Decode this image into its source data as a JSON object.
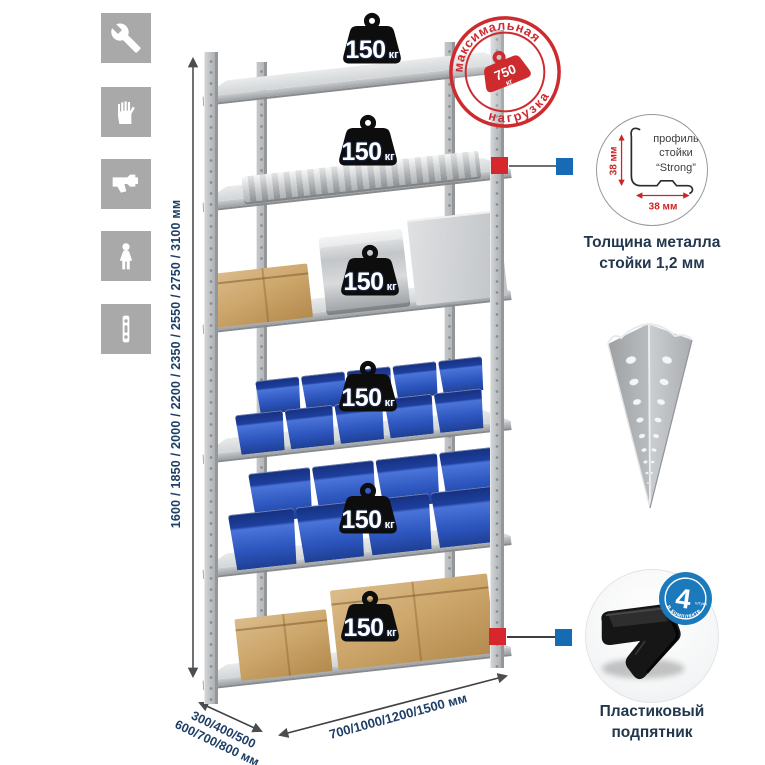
{
  "sidebar": {
    "items": [
      {
        "icon": "wrench-icon"
      },
      {
        "icon": "gloves-icon"
      },
      {
        "icon": "drill-icon"
      },
      {
        "icon": "person-icon"
      },
      {
        "icon": "perforated-strip-icon"
      }
    ]
  },
  "dimensions": {
    "height": "1600 / 1850 / 2000 / 2200 / 2350 / 2550 / 2750 / 3100 мм",
    "depth_line1": "300/400/500",
    "depth_line2": "600/700/800 мм",
    "width": "700/1000/1200/1500 мм"
  },
  "stamp": {
    "arc_top": "максимальная",
    "arc_bottom": "нагрузка",
    "value": "750",
    "unit": "кг",
    "color": "#ce2b2f"
  },
  "rack": {
    "shelf_loads": [
      {
        "value": "150",
        "unit": "кг"
      },
      {
        "value": "150",
        "unit": "кг"
      },
      {
        "value": "150",
        "unit": "кг"
      },
      {
        "value": "150",
        "unit": "кг"
      },
      {
        "value": "150",
        "unit": "кг"
      },
      {
        "value": "150",
        "unit": "кг"
      }
    ]
  },
  "details": {
    "profile": {
      "line1": "профиль",
      "line2": "стойки",
      "line3": "“Strong”",
      "dim_v": "38 мм",
      "dim_h": "38 мм",
      "caption1": "Толщина металла",
      "caption2": "стойки 1,2 мм"
    },
    "foot": {
      "badge_value": "4",
      "badge_small": "штуки",
      "badge_arc": "в комплекте",
      "caption1": "Пластиковый",
      "caption2": "подпятник"
    }
  },
  "colors": {
    "accent_red": "#ce2b2f",
    "badge_blue": "#1b79bc",
    "bin_blue": "#2c55bd",
    "navy_text": "#1d3e66"
  }
}
